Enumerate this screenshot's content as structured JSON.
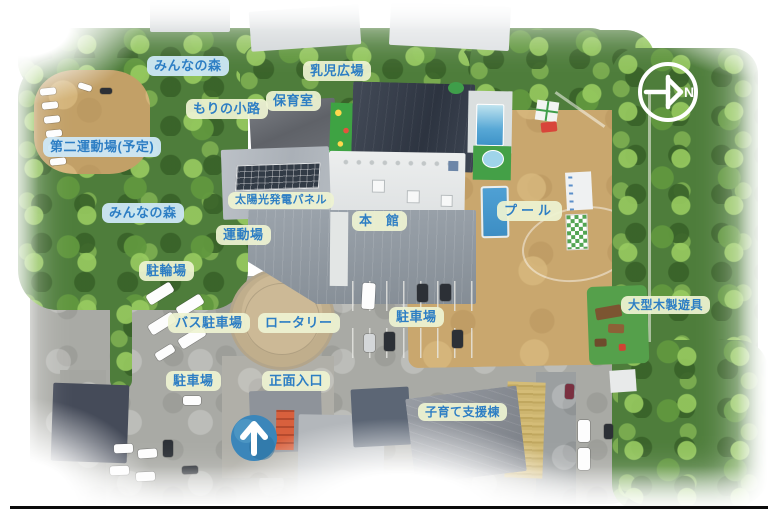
{
  "image_type": "annotated-aerial-photo-map",
  "compass": {
    "letter": "N"
  },
  "entrance_arrow": {
    "icon": "up-arrow"
  },
  "label_style": {
    "text_color": "#2d7ec4",
    "cream_bg": "#eef3d2",
    "blue_bg": "#cde8f7"
  },
  "labels": [
    {
      "id": "minna-no-mori-north",
      "text": "みんなの森",
      "variant": "blue",
      "x": 147,
      "y": 56
    },
    {
      "id": "nyuji-hiroba",
      "text": "乳児広場",
      "variant": "cream",
      "x": 303,
      "y": 61
    },
    {
      "id": "hoikushitsu",
      "text": "保育室",
      "variant": "cream",
      "x": 266,
      "y": 91
    },
    {
      "id": "mori-no-komichi",
      "text": "もりの小路",
      "variant": "cream",
      "x": 186,
      "y": 99
    },
    {
      "id": "daini-undojo-yotei",
      "text": "第二運動場(予定)",
      "variant": "blue",
      "x": 43,
      "y": 137
    },
    {
      "id": "taiyoko-hatsuden-panel",
      "text": "太陽光発電パネル",
      "variant": "cream",
      "x": 228,
      "y": 192,
      "size": 11
    },
    {
      "id": "minna-no-mori-west",
      "text": "みんなの森",
      "variant": "blue",
      "x": 102,
      "y": 203
    },
    {
      "id": "pool",
      "text": "プール",
      "variant": "cream",
      "x": 497,
      "y": 201,
      "ls": 4
    },
    {
      "id": "honkan",
      "text": "本　館",
      "variant": "cream",
      "x": 352,
      "y": 211
    },
    {
      "id": "undojo",
      "text": "運動場",
      "variant": "cream",
      "x": 216,
      "y": 225
    },
    {
      "id": "churinjo",
      "text": "駐輪場",
      "variant": "cream",
      "x": 139,
      "y": 261
    },
    {
      "id": "ogata-mokusei-yugu",
      "text": "大型木製遊具",
      "variant": "cream",
      "x": 621,
      "y": 296,
      "size": 12
    },
    {
      "id": "chushajo-east",
      "text": "駐車場",
      "variant": "cream",
      "x": 389,
      "y": 307
    },
    {
      "id": "bus-chushajo",
      "text": "バス駐車場",
      "variant": "cream",
      "x": 168,
      "y": 313
    },
    {
      "id": "rotary",
      "text": "ロータリー",
      "variant": "cream",
      "x": 258,
      "y": 313
    },
    {
      "id": "chushajo-south",
      "text": "駐車場",
      "variant": "cream",
      "x": 166,
      "y": 371
    },
    {
      "id": "shomen-iriguchi",
      "text": "正面入口",
      "variant": "cream",
      "x": 262,
      "y": 371
    },
    {
      "id": "kosodate-shien-to",
      "text": "子育て支援棟",
      "variant": "cream",
      "x": 418,
      "y": 403,
      "size": 12
    }
  ]
}
